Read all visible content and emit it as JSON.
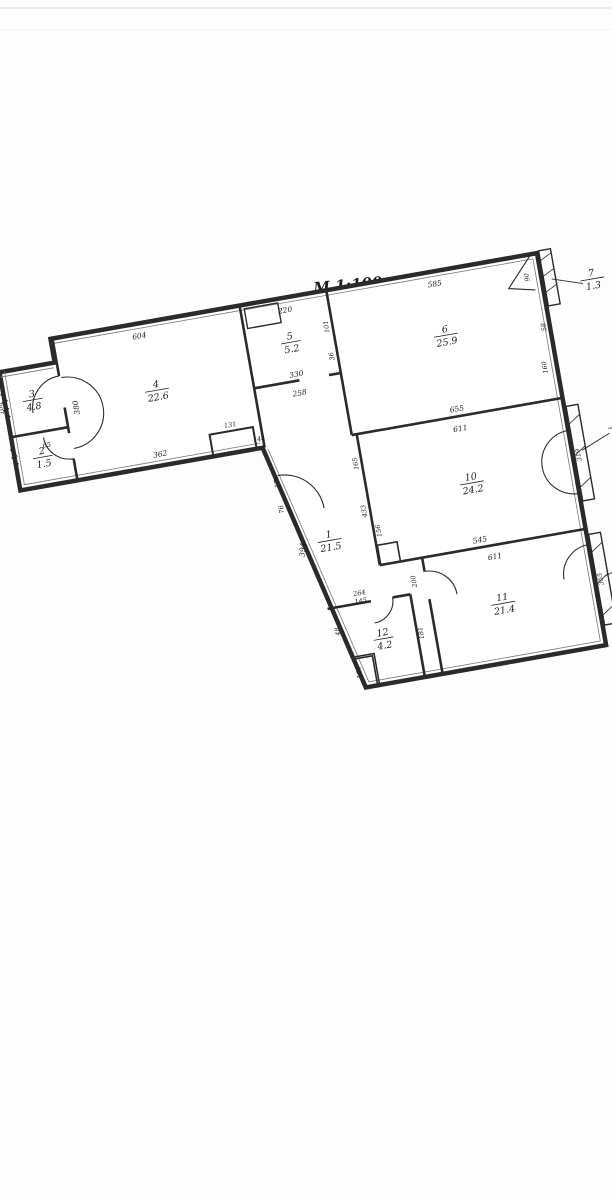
{
  "title": "M 1:100",
  "rooms": [
    {
      "num": "1",
      "area": "21.5"
    },
    {
      "num": "2",
      "area": "1.5"
    },
    {
      "num": "3",
      "area": "4.8"
    },
    {
      "num": "4",
      "area": "22.6"
    },
    {
      "num": "5",
      "area": "5.2"
    },
    {
      "num": "6",
      "area": "25.9"
    },
    {
      "num": "7",
      "area": "1.3"
    },
    {
      "num": "8",
      "area": "1.0"
    },
    {
      "num": "9",
      "area": "1.0"
    },
    {
      "num": "10",
      "area": "24.2"
    },
    {
      "num": "11",
      "area": "21.4"
    },
    {
      "num": "12",
      "area": "4.2"
    }
  ],
  "dims": {
    "room4_top": "604",
    "room4_left": "380",
    "room4_bottom": "362",
    "niche_top": "131",
    "niche_right": "144",
    "room5_top": "220",
    "room5_right_a": "101",
    "room5_right_b": "36",
    "room5_bottom": "330",
    "corridor_top": "258",
    "room6_top": "585",
    "room6_bottom": "655",
    "room10_top": "611",
    "room10_bottom": "545",
    "room11_top": "611",
    "corridor_diag": "394",
    "corridor_left_a": "176",
    "corridor_left_b": "76",
    "corridor_right_a": "165",
    "corridor_right_b": "433",
    "corridor_right_c": "156",
    "shaft_side": "200",
    "room12_top_a": "264",
    "room12_top_b": "145",
    "room12_right": "181",
    "room12_left": "48",
    "room12_bottom": "104",
    "annex_left": "100",
    "annex_door": "65",
    "balcony7_a": "90",
    "balcony7_b": "58",
    "room6_right": "160",
    "balcony8_side": "319",
    "balcony9_side": "355"
  },
  "colors": {
    "wall": "#2a2a2a",
    "ink": "#1c1c1c"
  }
}
